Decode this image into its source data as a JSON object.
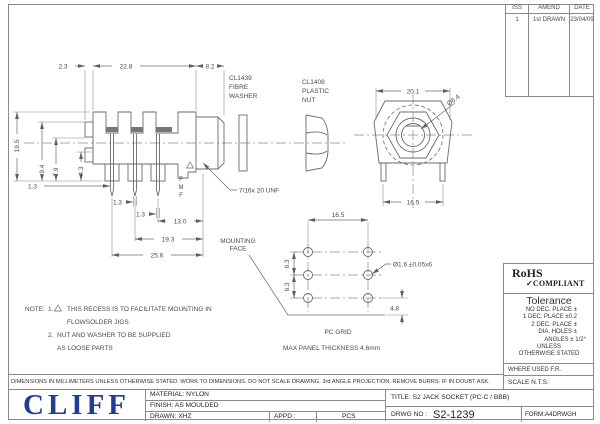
{
  "colors": {
    "logo_blue": "#1e3e96",
    "line": "#6b6b6b",
    "text": "#4a4a4a"
  },
  "revision_table": {
    "col_iss": "ISS",
    "col_amend": "AMEND",
    "col_date": "DATE",
    "row1_iss": "1",
    "row1_amend": "1st DRAWN",
    "row1_date": "23/04/09"
  },
  "dims": {
    "d2_3": "2.3",
    "d22_8": "22.8",
    "d8_2": "8.2",
    "d19_5": "19.5",
    "d9_4": "9.4",
    "d7_9": "7.9",
    "d4_3": "4.3",
    "d1_3_a": "1.3",
    "d1_3_b": "1.3",
    "d1_3_c": "1.3",
    "d13_0": "13.0",
    "d19_3": "19.3",
    "d25_6": "25.6",
    "d20_1": "20.1",
    "dia6_4": "Ø6.4",
    "d16_5_front": "16.5",
    "d16_5_grid": "16.5",
    "d6_3_a": "6.3",
    "d6_3_b": "6.3",
    "hole_callout": "Ø1.6 ±0.05x6",
    "d4_8": "4.8"
  },
  "labels": {
    "thread": "7/16x 20 UNF",
    "washer_1": "CL1439",
    "washer_2": "FIBRE",
    "washer_3": "WASHER",
    "nut_1": "CL1408",
    "nut_2": "PLASTIC",
    "nut_3": "NUT",
    "mounting_1": "MOUNTING",
    "mounting_2": "FACE",
    "pc_grid": "PC GRID",
    "panel": "MAX PANEL THICKNESS 4.6mm",
    "recess_f1": "F",
    "recess_m": "M",
    "recess_f2": "F"
  },
  "notes": {
    "prefix": "NOTE:",
    "n1_num": "1.",
    "n1_line1": "THIS RECESS IS TO  FACILITATE MOUNTING IN",
    "n1_line2": "FLOWSOLDER JIGS",
    "n2_num": "2.",
    "n2_line1": "NUT AND WASHER TO BE SUPPLIED",
    "n2_line2": "AS LOOSE PARTS"
  },
  "rohs": {
    "line1": "RoHS",
    "check": "✓",
    "line2": "COMPLIANT"
  },
  "tolerance": {
    "title": "Tolerance",
    "l1": "NO DEC. PLACE ±",
    "l2": "1 DEC. PLACE ±0.2",
    "l3": "2 DEC. PLACE ±",
    "l4": "DIA. HOLES ±",
    "l5": "ANGLES ± 1/2°",
    "l6": "UNLESS",
    "l7": "OTHERWISE STATED"
  },
  "where_used": "WHERE USED F.R.",
  "scale": "SCALE N.T.S.",
  "disclaimer": "DIMENSIONS IN MILLIMETERS UNLESS OTHERWISE STATED. WORK TO DIMENSIONS. DO NOT SCALE DRAWING. 3rd ANGLE PROJECTION. REMOVE BURRS. IF IN DOUBT ASK.",
  "title_block": {
    "logo": "CLIFF",
    "material_label": "MATERIAL:",
    "material": "NYLON",
    "finish_label": "FINISH:",
    "finish": "AS MOULDED",
    "drawn_label": "DRAWN:",
    "drawn": "XHZ",
    "appd_label": "APPD :",
    "appd": "PCS",
    "title_label": "TITLE:",
    "title": "S2 JACK SOCKET (PC-C / BBB)",
    "drwg_label": "DRWG  NO :",
    "drwg_no": "S2-1239",
    "form": "FORM:A4DRWGH"
  }
}
